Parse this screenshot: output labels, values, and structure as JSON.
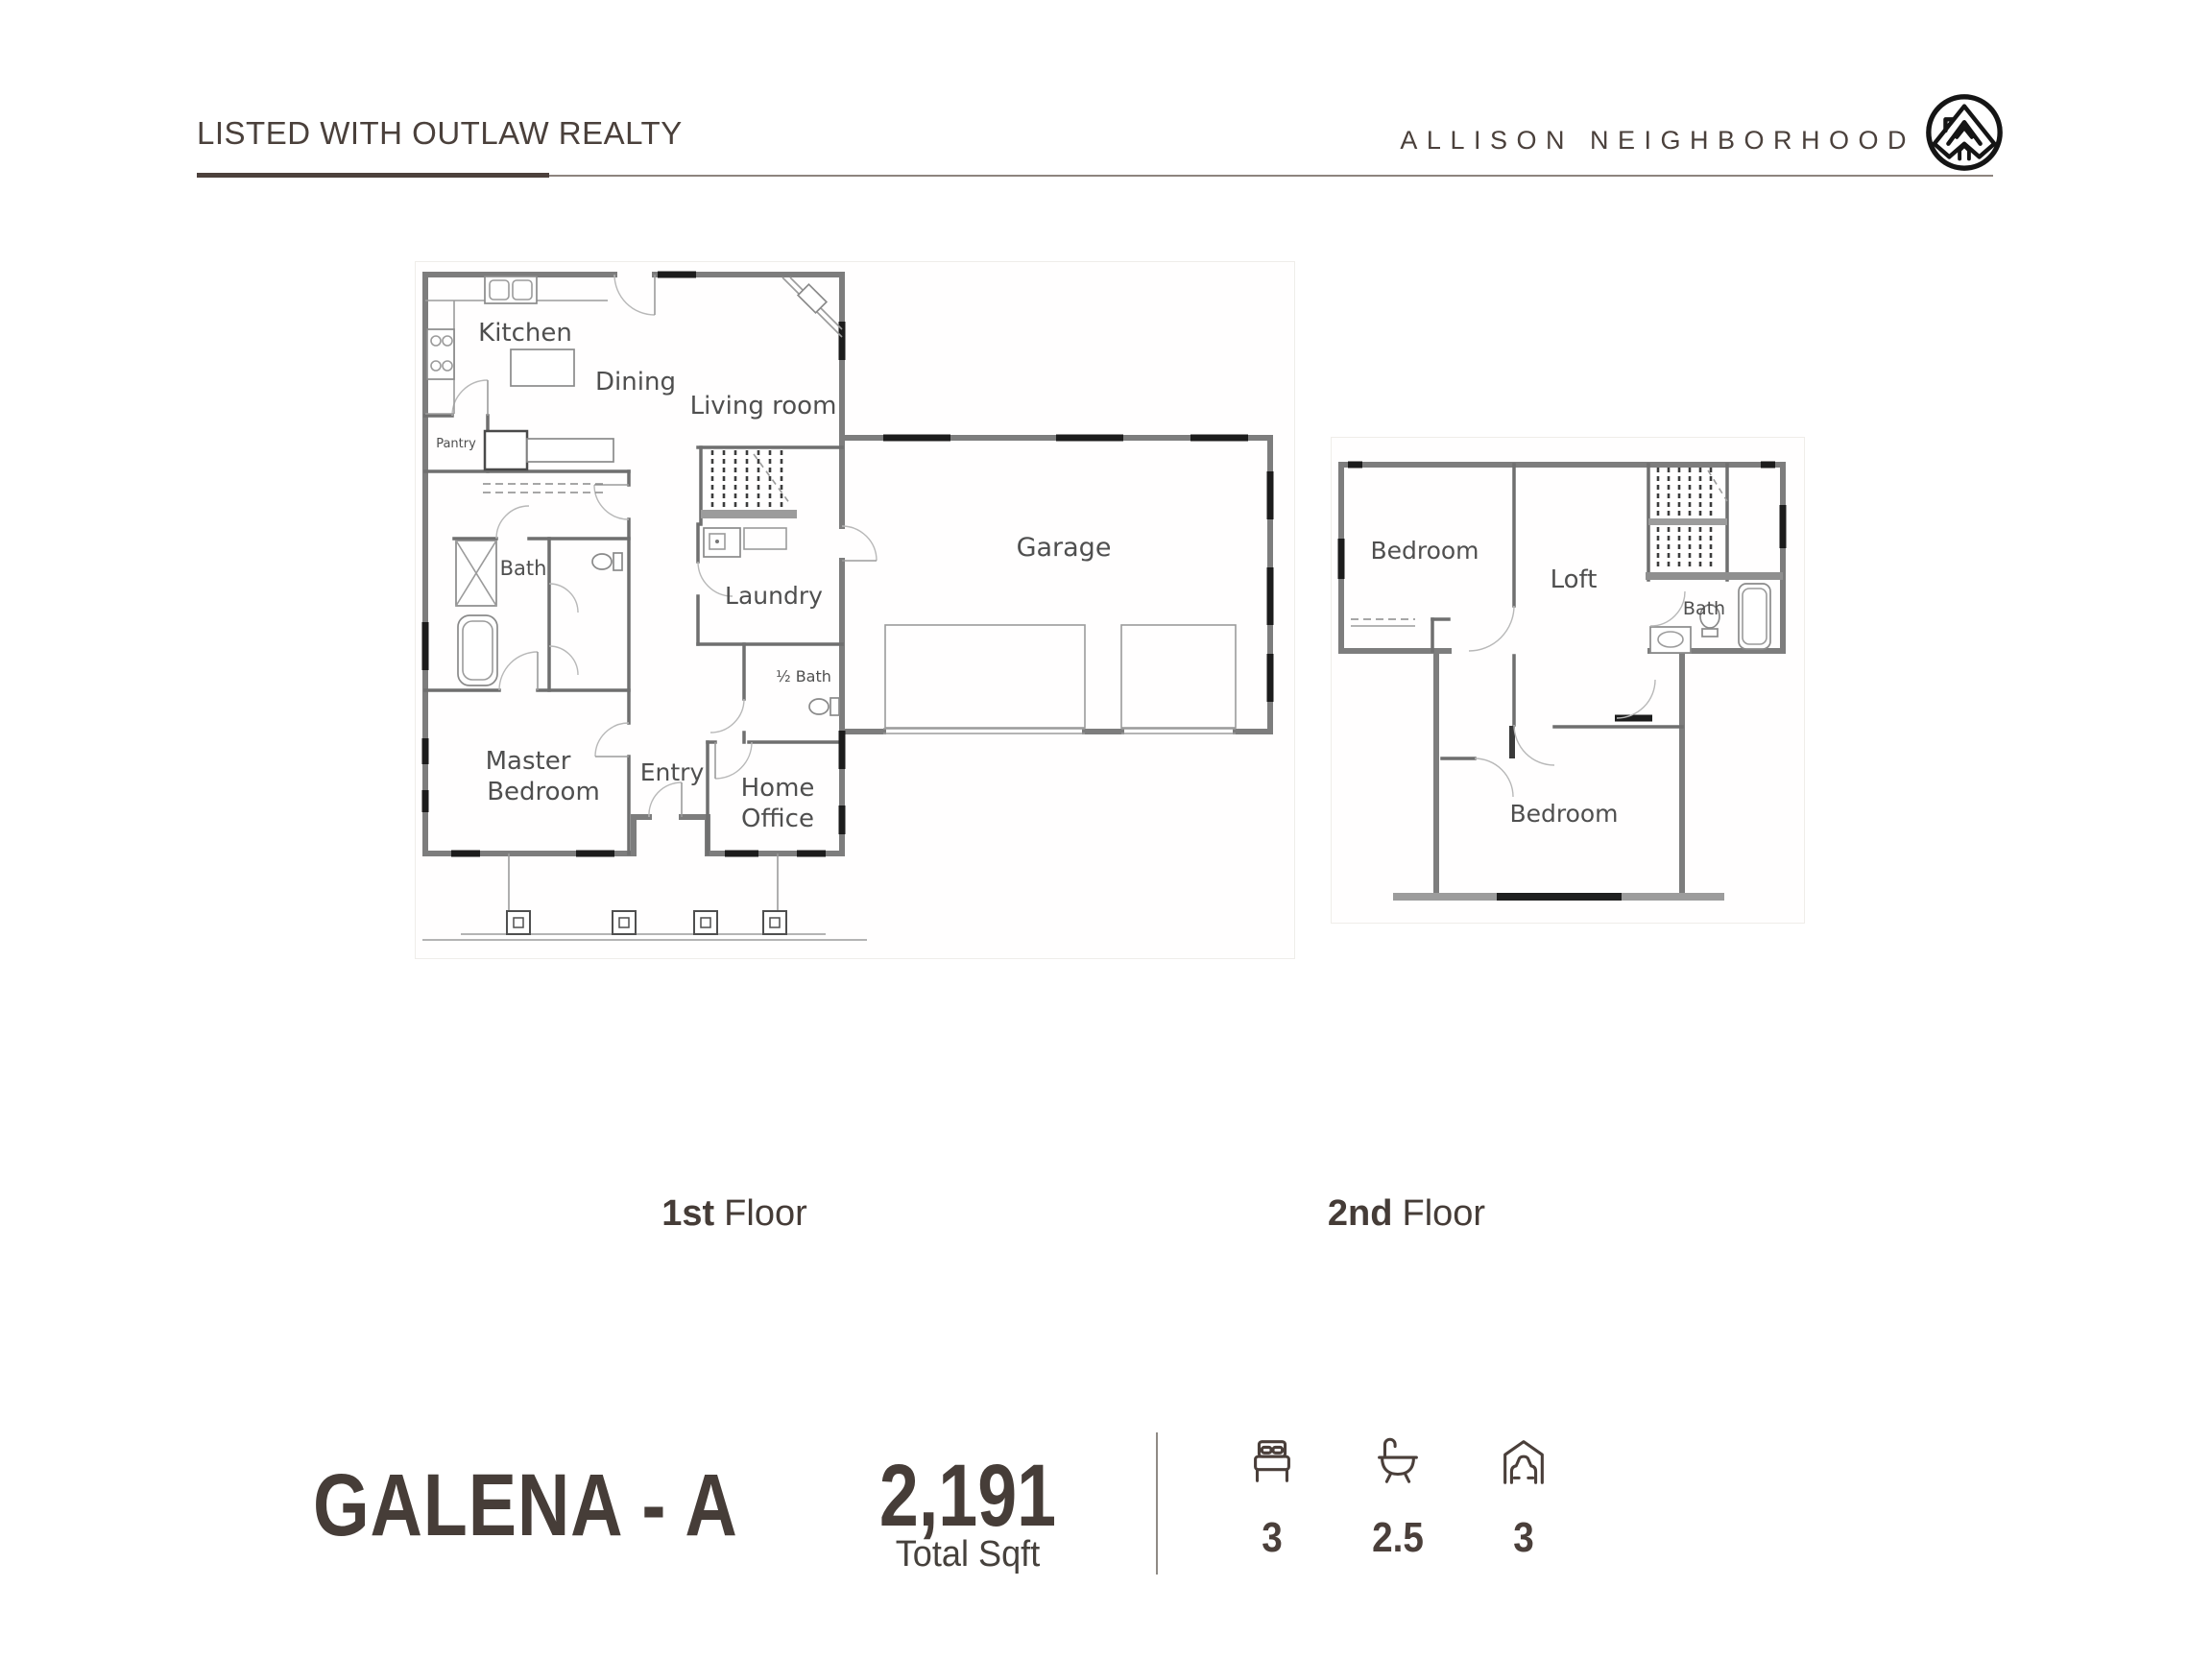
{
  "header": {
    "listed_with": "LISTED WITH OUTLAW REALTY",
    "neighborhood": "ALLISON NEIGHBORHOOD",
    "logo": "circle-a-house-monogram"
  },
  "plans": {
    "first": {
      "caption_bold": "1st",
      "caption_rest": "Floor",
      "rooms": {
        "kitchen": "Kitchen",
        "dining": "Dining",
        "living": "Living room",
        "pantry": "Pantry",
        "bath": "Bath",
        "laundry": "Laundry",
        "half_bath": "½ Bath",
        "garage": "Garage",
        "master_1": "Master",
        "master_2": "Bedroom",
        "entry": "Entry",
        "office_1": "Home",
        "office_2": "Office"
      }
    },
    "second": {
      "caption_bold": "2nd",
      "caption_rest": "Floor",
      "rooms": {
        "bedroom1": "Bedroom",
        "loft": "Loft",
        "bath": "Bath",
        "bedroom2": "Bedroom"
      }
    }
  },
  "footer": {
    "plan_name": "GALENA - A",
    "sqft_value": "2,191",
    "sqft_label": "Total Sqft",
    "stats": [
      {
        "name": "bedrooms",
        "icon": "bed-icon",
        "value": "3"
      },
      {
        "name": "bathrooms",
        "icon": "bathtub-icon",
        "value": "2.5"
      },
      {
        "name": "garages",
        "icon": "garage-icon",
        "value": "3"
      }
    ]
  },
  "colors": {
    "accent_brown": "#4a3f3a",
    "underline_thick": "#4c413c",
    "underline_thin": "#8d847e",
    "plan_text": "#4f4f4f",
    "wall_gray": "#7d7d7d",
    "window_black": "#1c1c1c",
    "logo_black": "#151515"
  }
}
